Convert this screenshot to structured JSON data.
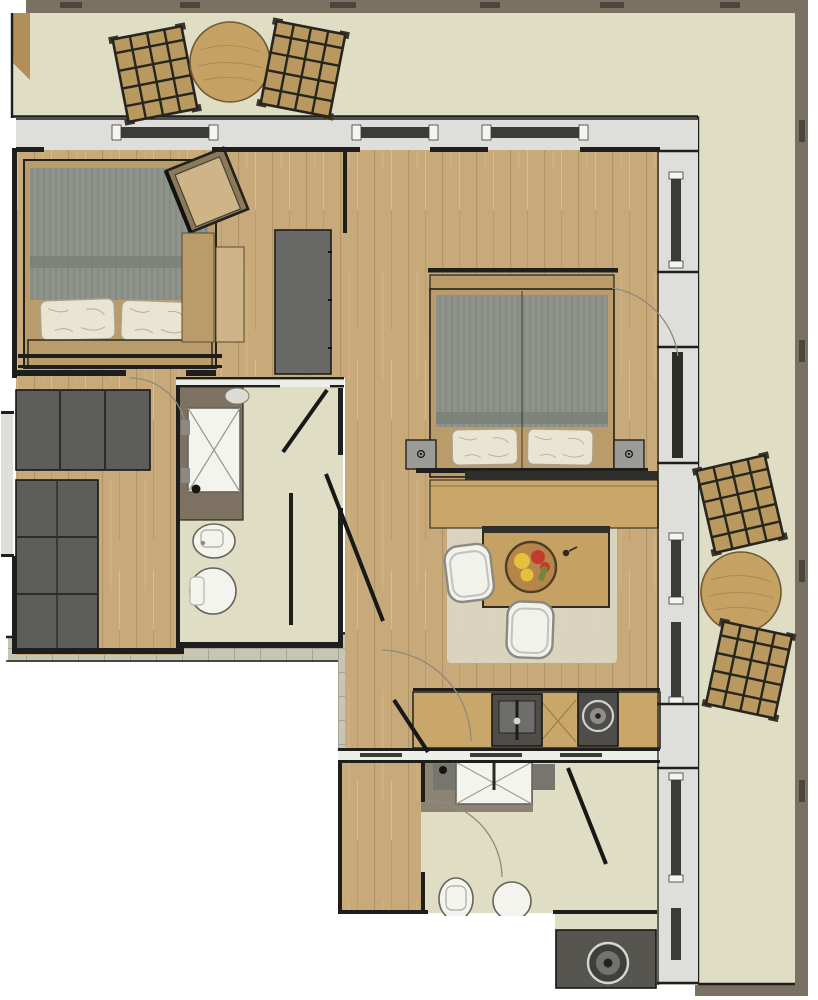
{
  "plan": {
    "kind": "apartment-floor-plan",
    "view": "top-down-rendered",
    "rooms": [
      {
        "id": "balcony-top",
        "desc": "upper terrace with two slatted deck chairs and round table"
      },
      {
        "id": "balcony-right",
        "desc": "right-side terrace with two slatted deck chairs and round table"
      },
      {
        "id": "bedroom-left",
        "desc": "bedroom with double bed, lounge chair, dressers, tall dark cabinet"
      },
      {
        "id": "dressing-room",
        "desc": "walk-in closet with dark wardrobe units"
      },
      {
        "id": "bathroom-main",
        "desc": "bathroom with vanity, shower, bidet and toilet"
      },
      {
        "id": "living-bedroom",
        "desc": "main room with double bed, nightstands, console desk, dining table, two chairs, rug"
      },
      {
        "id": "kitchen",
        "desc": "kitchenette with sink and cooktop along wall"
      },
      {
        "id": "entrance-hall",
        "desc": "entry hall reached from tiled walkway"
      },
      {
        "id": "bathroom-lower",
        "desc": "second bathroom with vanity, toilet, round basin"
      },
      {
        "id": "utility",
        "desc": "utility nook with washing machine"
      }
    ],
    "furniture": [
      "deck-chair",
      "round-wood-table",
      "double-bed",
      "pillow",
      "duvet",
      "lounge-chair",
      "dresser",
      "tall-cabinet",
      "wardrobe-unit",
      "vanity",
      "shower-tray",
      "bidet",
      "toilet",
      "nightstand",
      "console-desk",
      "dining-table",
      "fruit-tray",
      "dining-chair",
      "rug",
      "kitchen-sink",
      "cooktop",
      "washing-machine",
      "door-leaf",
      "door-swing-arc",
      "window"
    ]
  },
  "colors": {
    "background": "#ffffff",
    "outerWall": "#7b7162",
    "outerWallDark": "#4c463c",
    "balconyFloor": "#dfddc4",
    "tileFloor": "#c9c5b4",
    "tileLine": "#a8a493",
    "woodFloor": "#c7a97a",
    "woodFloorLight": "#cfb488",
    "furnitureWood": "#ba9b6a",
    "counterWood": "#c9a76b",
    "tableWood": "#c6a164",
    "trayWood": "#b5854a",
    "exteriorZone": "#dededb",
    "wallWhite": "#eceee8",
    "slabDark": "#686866",
    "closetDark": "#5d5d5b",
    "duvetGrey": "#8e948b",
    "duvetFold": "#798077",
    "pillowCream": "#eae4d2",
    "fixtureWhite": "#f4f4ef",
    "vanityBrown": "#7d7162",
    "matTaupe": "#8c8375",
    "applianceDark": "#4e4d49",
    "applianceLight": "#8e8d89",
    "rugBeige": "#dbd8c6",
    "chairWhite": "#f2f2ed",
    "outdoorWood": "#b9995f",
    "windowGlass": "#3c3c37",
    "utilityFloor": "#56554f",
    "nightstandGrey": "#9b9b97",
    "accentRed": "#c23b2c",
    "accentYellow": "#e4c03c",
    "accentGreen": "#75853c"
  }
}
